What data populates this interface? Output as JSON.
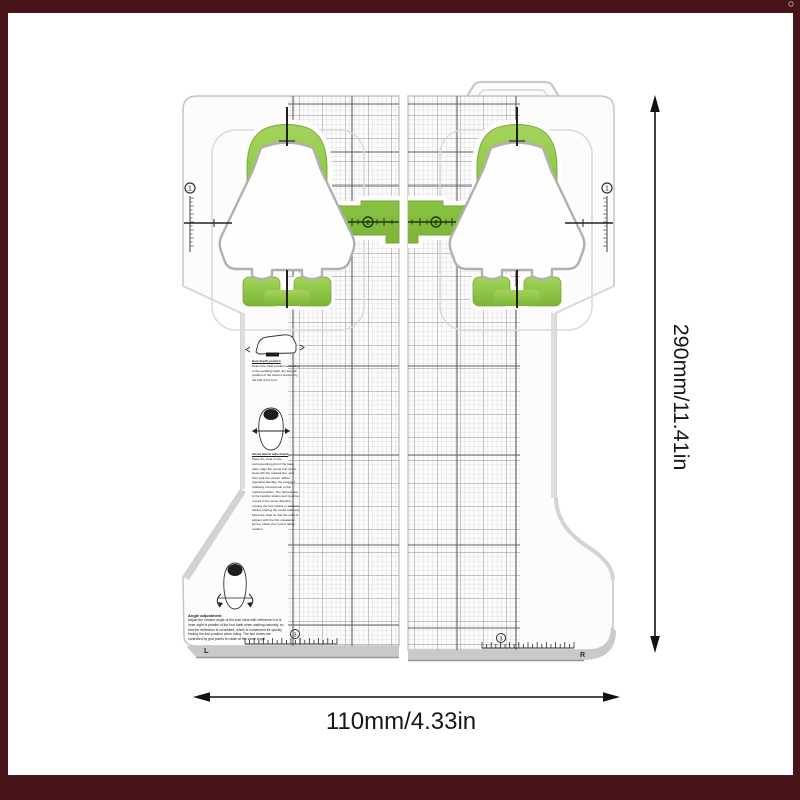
{
  "frame": {
    "color": "#471419"
  },
  "dimensions": {
    "height_label": "290mm/11.41in",
    "width_label": "110mm/4.33in"
  },
  "markers": {
    "ruler_left": "1",
    "ruler_right": "1",
    "band_left": "2",
    "band_right": "2",
    "bottom_left": "3",
    "bottom_right": "3",
    "foot_left": "L",
    "foot_right": "R"
  },
  "instructions": {
    "block_heel_title": "Heel depth position",
    "block_heel_body": "Select the cleat position according to the pedaling habit, the fore-aft position of the cleat is decided by the ball of the foot.",
    "block_place_title": "About lateral adjustment",
    "block_place_body": "Place the cleat on the corresponding grid of the base plate, align the center line of the cleat with the marked line, and then lock the screws. When operating laterally, the cleat set relatively corresponds to the marked position. The ball position is the transfer station and must be moved in the same direction, moving the foot inward or outward, always placing the cleats relatively. Move the cleat so that the mark is aligned with the first metatarsal joint to obtain the correct riding position.",
    "angle_title": "Angle adjustment",
    "angle_body": "Adjust the rotation angle of the sole shoe with reference to it is inner sight is parallel of the foot habit when walking naturally, so that the deflection is consistent, which is convenient for quickly finding the foot position when riding. The two shoes are controlled by grid points to rotate at the same angle."
  }
}
